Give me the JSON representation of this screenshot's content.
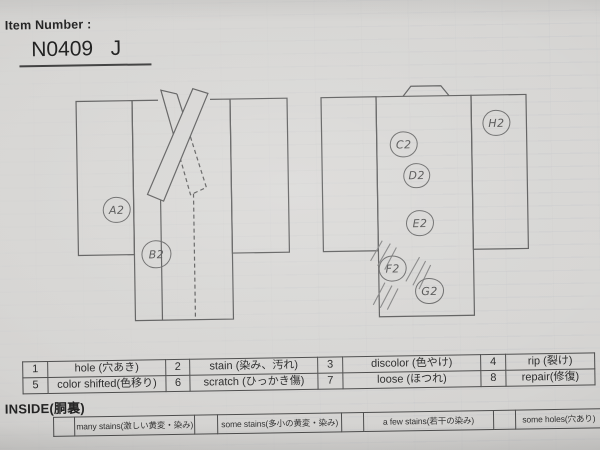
{
  "header": {
    "label": "Item Number :",
    "value": "N0409   J"
  },
  "defects": {
    "front": [
      {
        "label": "A2"
      },
      {
        "label": "B2"
      }
    ],
    "back": [
      {
        "label": "C2"
      },
      {
        "label": "D2"
      },
      {
        "label": "E2"
      },
      {
        "label": "F2"
      },
      {
        "label": "G2"
      },
      {
        "label": "H2"
      }
    ]
  },
  "legend": {
    "items": [
      {
        "num": "1",
        "label": "hole (穴あき)"
      },
      {
        "num": "2",
        "label": "stain (染み、汚れ)"
      },
      {
        "num": "3",
        "label": "discolor (色やけ)"
      },
      {
        "num": "4",
        "label": "rip (裂け)"
      },
      {
        "num": "5",
        "label": "color shifted(色移り)"
      },
      {
        "num": "6",
        "label": "scratch (ひっかき傷)"
      },
      {
        "num": "7",
        "label": "loose (ほつれ)"
      },
      {
        "num": "8",
        "label": "repair(修復)"
      }
    ]
  },
  "inside": {
    "title": "INSIDE(胴裏)",
    "items": [
      {
        "label": "many stains(激しい黄変・染み)"
      },
      {
        "label": "some stains(多小の黄変・染み)"
      },
      {
        "label": "a few stains(若干の染み)"
      },
      {
        "label": "some holes(穴あり)"
      }
    ]
  }
}
